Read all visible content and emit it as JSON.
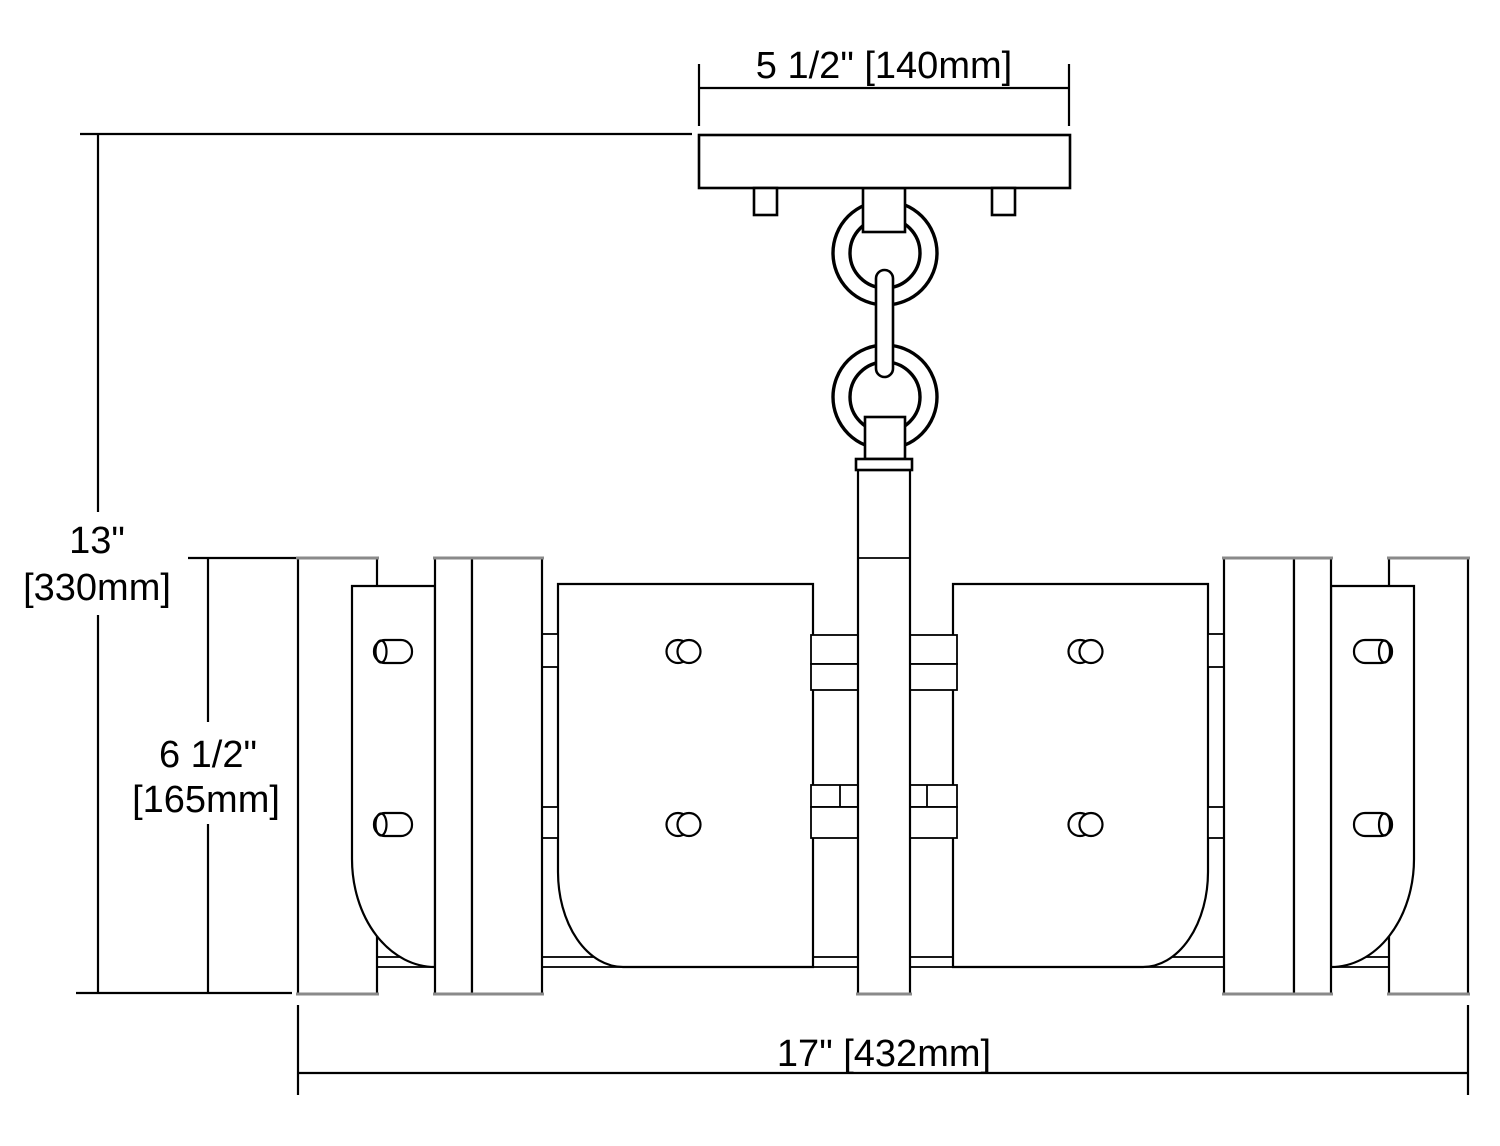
{
  "page": {
    "background": "#ffffff",
    "line_color": "#000000",
    "secondary_line_color": "#8a8a8a"
  },
  "dimensions": {
    "canopy_width": {
      "label": "5 1/2\" [140mm]"
    },
    "overall_height": {
      "value": "13\"",
      "metric": "[330mm]"
    },
    "body_height": {
      "value": "6 1/2\"",
      "metric": "[165mm]"
    },
    "overall_width": {
      "label": "17\" [432mm]"
    }
  }
}
